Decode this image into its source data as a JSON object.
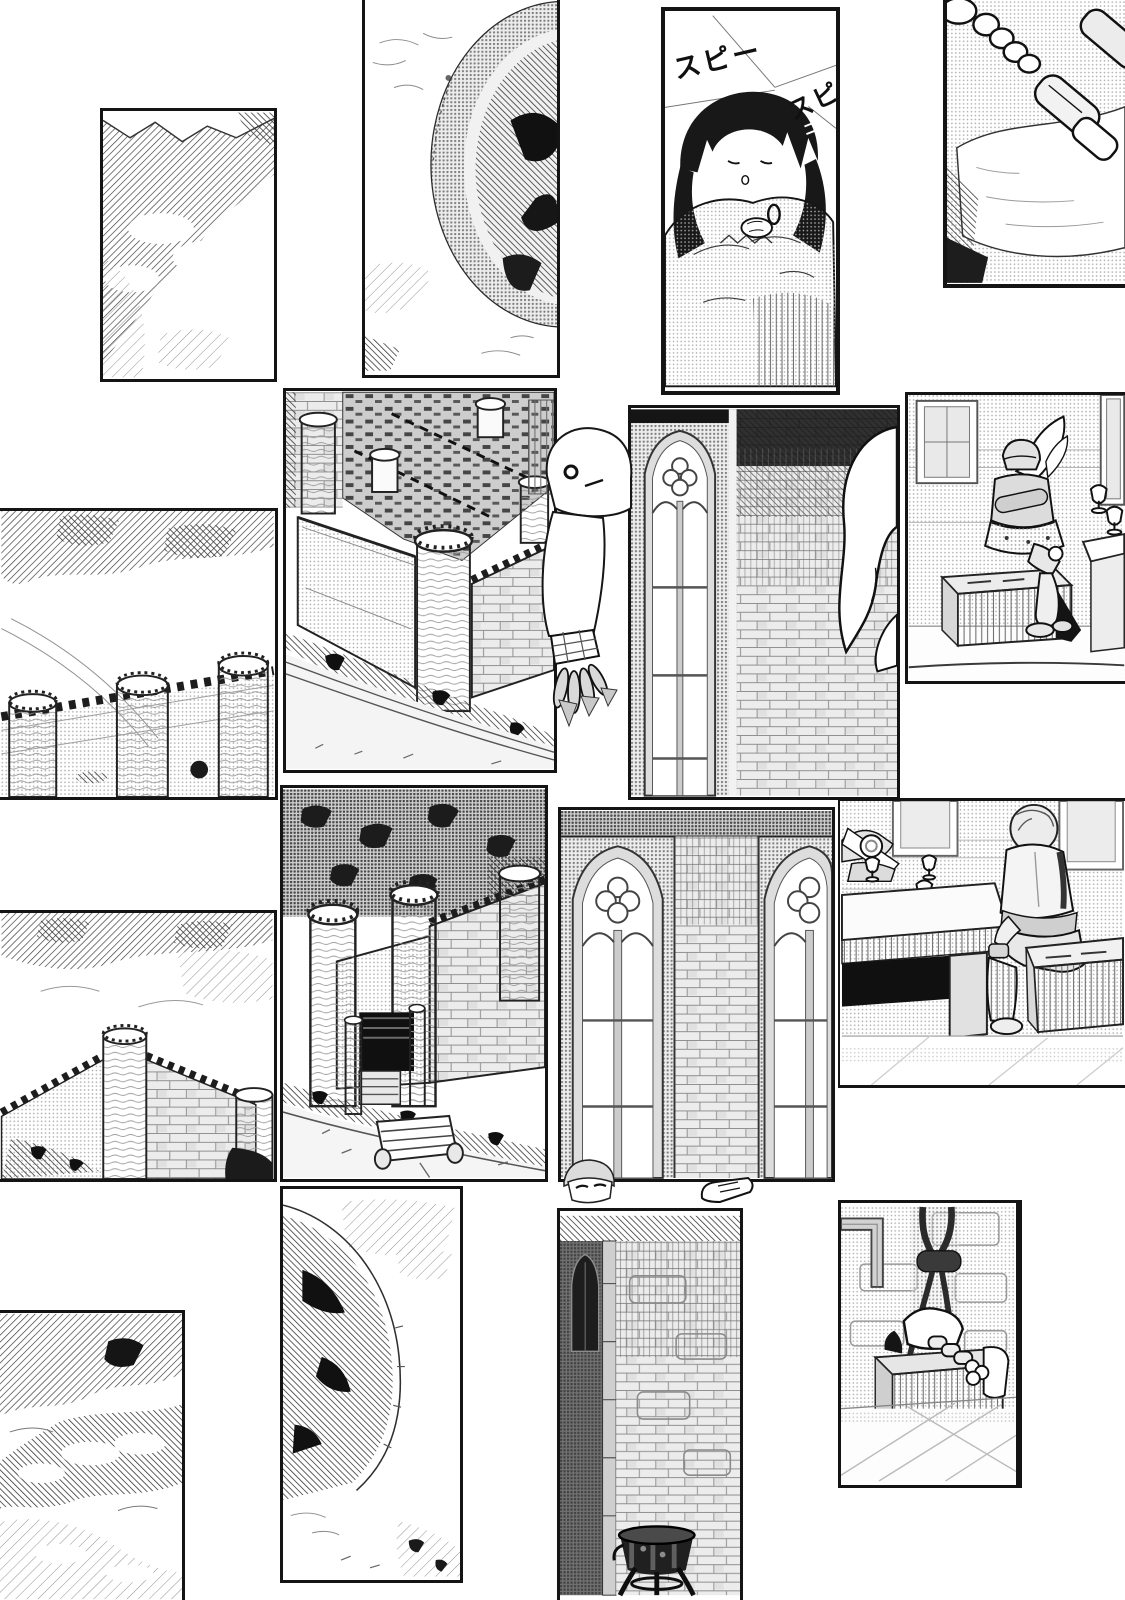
{
  "page": {
    "background": "#ffffff",
    "ink": "#141414"
  },
  "sfx": {
    "sleep_1": "スピー",
    "sleep_2": "スピ"
  },
  "panels": [
    {
      "id": "p1",
      "scene": "hatched mountain slope with clouds"
    },
    {
      "id": "p2",
      "scene": "dark domed crater seen from above"
    },
    {
      "id": "p3",
      "scene": "girl sleeping wrapped in a cloak, sleeping sound effects"
    },
    {
      "id": "p4",
      "scene": "armored sabatons and greaves resting on a bed"
    },
    {
      "id": "p5",
      "scene": "castle curtain wall with three round towers under cloud"
    },
    {
      "id": "p6",
      "scene": "aerial view of a walled castle town with corner tower"
    },
    {
      "id": "p7",
      "scene": "tall gothic window beside a dark brick wall, white creature at edge"
    },
    {
      "id": "p8",
      "scene": "armored knight seated on a bench beside a table with goblets"
    },
    {
      "id": "p9",
      "scene": "castle wall corner with two towers and dark dome"
    },
    {
      "id": "p10",
      "scene": "castle gatehouse with stairs, towers and outer rampart"
    },
    {
      "id": "p11",
      "scene": "two gothic windows flanking a brick pillar"
    },
    {
      "id": "p12",
      "scene": "bowed knight and light-haired boy at a table with three goblets"
    },
    {
      "id": "p13",
      "scene": "hatched cloud masses"
    },
    {
      "id": "p14",
      "scene": "dark dome rim with mist and scrub"
    },
    {
      "id": "p15",
      "scene": "brick wall with dark doorway and iron brazier"
    },
    {
      "id": "p16",
      "scene": "armored arm resting on a padded bench below hanging ropes"
    }
  ],
  "overlays": [
    {
      "id": "ghost",
      "scene": "small white spirit with round eye and clawed grey hand breaking the frame"
    },
    {
      "id": "face",
      "scene": "face peeking over the panel border"
    },
    {
      "id": "hand",
      "scene": "small hand over the panel border"
    }
  ]
}
